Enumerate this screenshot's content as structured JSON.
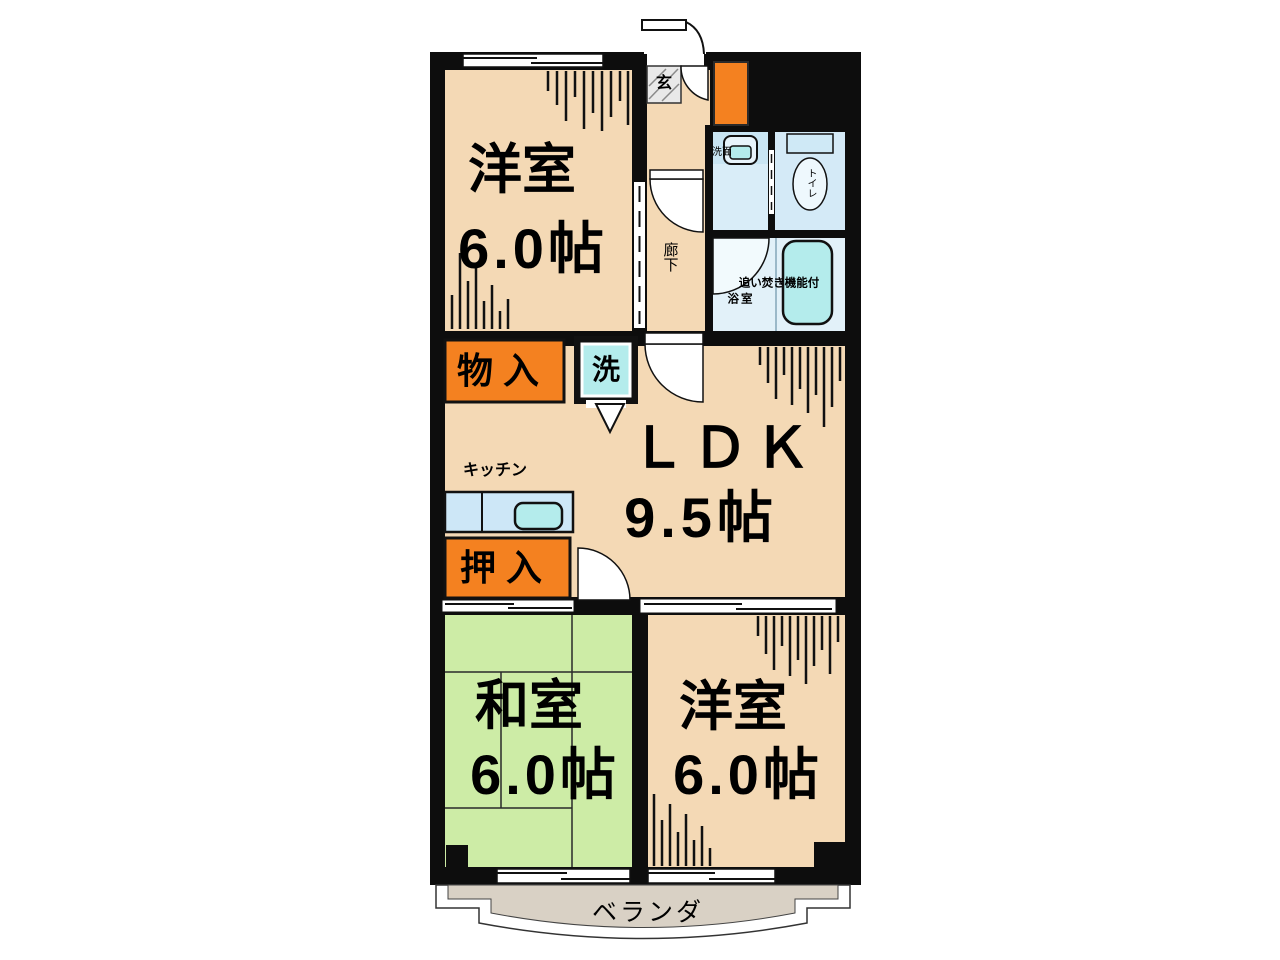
{
  "plan": {
    "type": "floorplan",
    "entrance_label": "玄",
    "hallway_label": "廊下",
    "rooms": {
      "western_top": {
        "label": "洋室",
        "size": "6.0帖"
      },
      "ldk": {
        "label": "ＬＤＫ",
        "size": "9.5帖"
      },
      "japanese": {
        "label": "和室",
        "size": "6.0帖"
      },
      "western_bottom": {
        "label": "洋室",
        "size": "6.0帖"
      }
    },
    "kitchen_label": "キッチン",
    "storage_label": "物入",
    "closet_label": "押入",
    "laundry_label": "洗",
    "washroom_label": "洗面",
    "toilet_label": "トイレ",
    "bath_feature_label": "追い焚き機能付",
    "bath_label": "浴室",
    "veranda_label": "ベランダ"
  },
  "colors": {
    "wall": "#0d0d0d",
    "floor_beige": "#f4d9b5",
    "tatami_green": "#cdeca6",
    "closet_orange": "#f48120",
    "wet_blue": "#d9edf8",
    "fixture_cyan": "#b4ecec",
    "counter_blue": "#cde7f7",
    "veranda_gray": "#d9d1c5"
  }
}
